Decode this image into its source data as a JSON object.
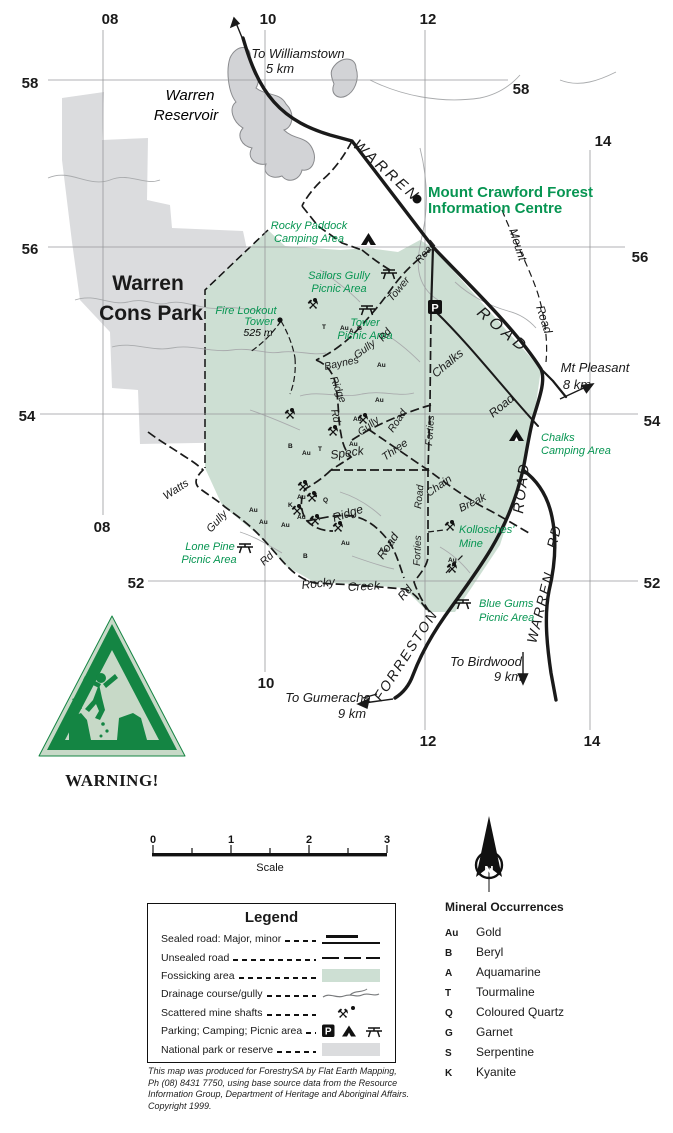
{
  "map": {
    "grid": {
      "eastings": [
        "08",
        "10",
        "12",
        "14"
      ],
      "northings": [
        "58",
        "56",
        "54",
        "52"
      ]
    },
    "directions": {
      "williamstown": [
        "To Williamstown",
        "5 km"
      ],
      "gumeracha": [
        "To Gumeracha",
        "9 km"
      ],
      "birdwood": [
        "To Birdwood",
        "9 km"
      ],
      "mt_pleasant": [
        "Mt Pleasant",
        "8 km"
      ]
    },
    "water": {
      "reservoir": [
        "Warren",
        "Reservoir"
      ]
    },
    "park": {
      "name": [
        "Warren",
        "Cons Park"
      ]
    },
    "poi": {
      "info_centre": [
        "Mount Crawford Forest",
        "Information Centre"
      ],
      "rocky_paddock": [
        "Rocky Paddock",
        "Camping Area"
      ],
      "sailors_gully": [
        "Sailors Gully",
        "Picnic Area"
      ],
      "tower_picnic": [
        "Tower",
        "Picnic Area"
      ],
      "fire_lookout": [
        "Fire Lookout",
        "Tower",
        "525 m"
      ],
      "chalks_camping": [
        "Chalks",
        "Camping Area"
      ],
      "kollosches": [
        "Kollosches'",
        "Mine"
      ],
      "lone_pine": [
        "Lone Pine",
        "Picnic Area"
      ],
      "blue_gums": [
        "Blue Gums",
        "Picnic Area"
      ]
    },
    "roads": {
      "warren_upper": "WARREN",
      "road_upper": "ROAD",
      "road_mid": "ROAD",
      "warren_rd": [
        "WARREN",
        "RD"
      ],
      "forreston": "FORRESTON",
      "mount_road": [
        "Mount",
        "Road"
      ],
      "tower_road": [
        "Tower",
        "Road"
      ],
      "gully_rd": [
        "Gully",
        "Rd"
      ],
      "chalks_road": [
        "Chalks",
        "Road"
      ],
      "baynes_ridge": [
        "Baynes",
        "Ridge",
        "Rd"
      ],
      "gully_road": [
        "Gully",
        "Road"
      ],
      "three_chain": [
        "Three",
        "Chain",
        "Break"
      ],
      "forties_road": [
        "Forties",
        "Road",
        "Forties"
      ],
      "ridge_road": [
        "Ridge",
        "Road"
      ],
      "watts_gully": [
        "Watts",
        "Gully",
        "Rd"
      ],
      "rocky_creek": [
        "Rocky",
        "Creek",
        "Rd"
      ],
      "speck": "Speck"
    },
    "mineral_marks": [
      "T",
      "Au",
      "A",
      "G",
      "Au",
      "Au",
      "Au",
      "Au",
      "B",
      "Au",
      "T",
      "K",
      "Au",
      "S",
      "Q",
      "Au",
      "Au",
      "Au",
      "Au",
      "B",
      "Au",
      "Au",
      "Au"
    ],
    "icons": {
      "parking_letter": "P"
    }
  },
  "warning": {
    "label": "WARNING!"
  },
  "scale": {
    "ticks": [
      "0",
      "1",
      "2",
      "3"
    ],
    "label": "Scale"
  },
  "north": {
    "letter": "N"
  },
  "legend": {
    "title": "Legend",
    "items": [
      {
        "label": "Sealed road: Major, minor",
        "symbol": "sealed-road"
      },
      {
        "label": "Unsealed road",
        "symbol": "unsealed-road"
      },
      {
        "label": "Fossicking area",
        "symbol": "fossicking-area-swatch"
      },
      {
        "label": "Drainage course/gully",
        "symbol": "drainage-squiggle"
      },
      {
        "label": "Scattered mine shafts",
        "symbol": "mine-shaft-icon"
      },
      {
        "label": "Parking; Camping; Picnic area",
        "symbol": "parking-camping-picnic-icons"
      },
      {
        "label": "National park or reserve",
        "symbol": "park-swatch"
      }
    ]
  },
  "minerals": {
    "title": "Mineral Occurrences",
    "items": [
      {
        "symbol": "Au",
        "name": "Gold"
      },
      {
        "symbol": "B",
        "name": "Beryl"
      },
      {
        "symbol": "A",
        "name": "Aquamarine"
      },
      {
        "symbol": "T",
        "name": "Tourmaline"
      },
      {
        "symbol": "Q",
        "name": "Coloured Quartz"
      },
      {
        "symbol": "G",
        "name": "Garnet"
      },
      {
        "symbol": "S",
        "name": "Serpentine"
      },
      {
        "symbol": "K",
        "name": "Kyanite"
      }
    ]
  },
  "credit": {
    "lines": [
      "This map was produced for ForestrySA by Flat Earth Mapping,",
      "Ph (08) 8431 7750, using base source data from the Resource",
      "Information Group, Department of Heritage and Aboriginal Affairs.",
      "Copyright 1999."
    ]
  },
  "colors": {
    "fossicking_green": "#cddfd3",
    "park_grey": "#dbdcde",
    "water_grey": "#d2d3d6",
    "label_green": "#079552",
    "warning_green": "#148543",
    "road_black": "#1a1a1a"
  }
}
